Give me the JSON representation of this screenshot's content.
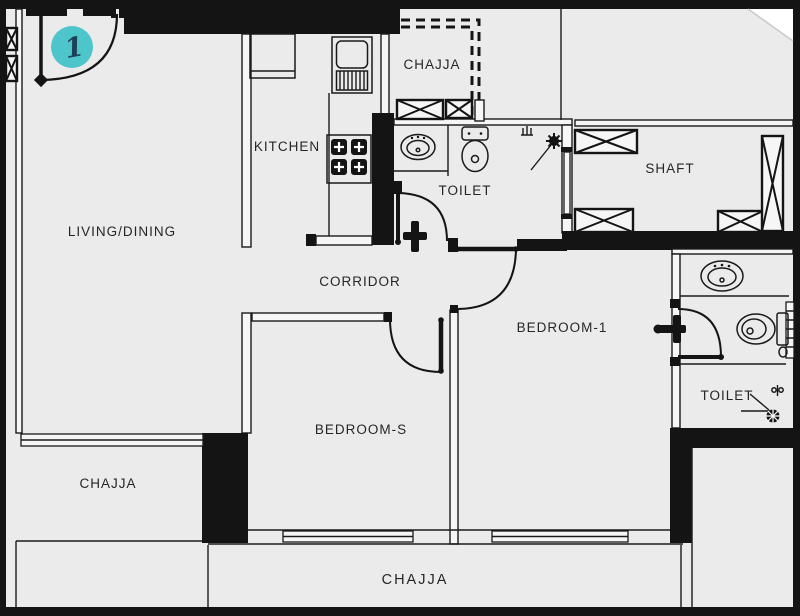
{
  "plan": {
    "unit_badge": {
      "number": "1"
    },
    "rooms": {
      "living_dining": "LIVING/DINING",
      "kitchen": "KITCHEN",
      "chajja_top": "CHAJJA",
      "toilet_common": "TOILET",
      "shaft": "SHAFT",
      "corridor": "CORRIDOR",
      "bedroom_1": "BEDROOM-1",
      "bedroom_s": "BEDROOM-S",
      "toilet_attached": "TOILET",
      "chajja_left": "CHAJJA",
      "chajja_bottom": "CHAJJA"
    },
    "fixtures": [
      "entry-door",
      "kitchen-sink",
      "gas-hob",
      "kitchen-counter",
      "wash-basin",
      "water-closet",
      "shower-head",
      "shower-mixer",
      "health-tap",
      "floor-drain",
      "column-marker",
      "window",
      "louver-vent"
    ],
    "colors": {
      "floor": "#ebebeb",
      "line": "#1a1a1a",
      "frame": "#000000",
      "badge": "#4ec5cb",
      "badge_number": "#1d4059"
    }
  }
}
